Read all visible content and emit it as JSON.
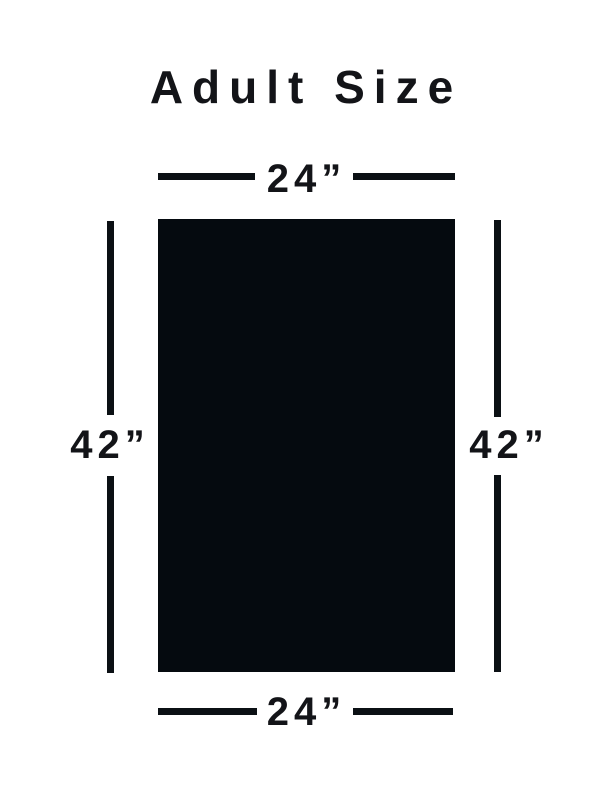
{
  "title": "Adult Size",
  "dimension_labels": {
    "top_width": "24”",
    "bottom_width": "24”",
    "left_height": "42”",
    "right_height": "42”"
  },
  "colors": {
    "background": "#ffffff",
    "text": "#131418",
    "line": "#0b1014",
    "rect": "#050a0f"
  }
}
